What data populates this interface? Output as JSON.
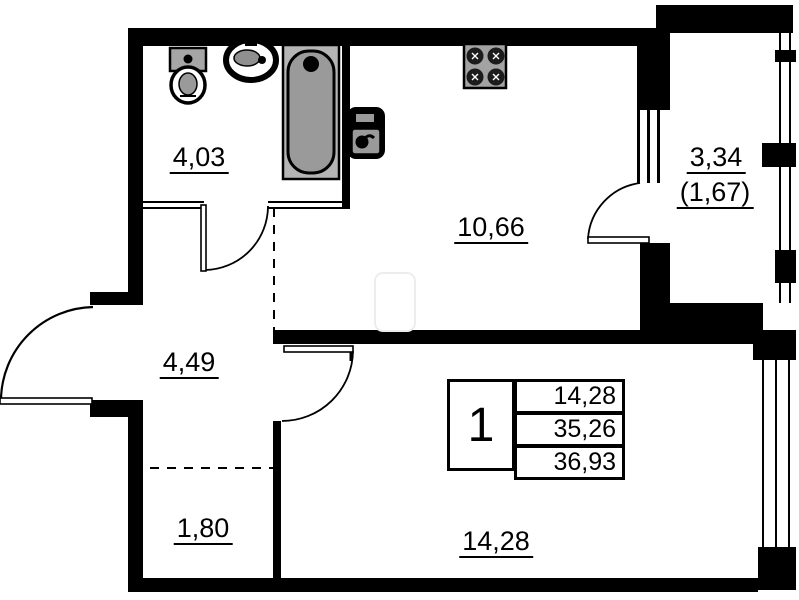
{
  "rooms": {
    "bathroom": {
      "area": "4,03"
    },
    "kitchen": {
      "area": "10,66"
    },
    "balcony": {
      "area": "3,34",
      "area_reduced": "(1,67)"
    },
    "hallway": {
      "area": "4,49"
    },
    "wardrobe": {
      "area": "1,80"
    },
    "living_room": {
      "area": "14,28"
    }
  },
  "legend": {
    "room_count": "1",
    "living_area": "14,28",
    "apartment_area": "35,26",
    "total_area": "36,93"
  },
  "colors": {
    "walls": "#000000",
    "fixture_gray": "#a6a6a6",
    "tub_gray": "#9a9a9a",
    "paper": "#ffffff"
  },
  "fixtures": [
    "toilet",
    "washbasin",
    "bathtub",
    "kitchen-sink",
    "stove"
  ]
}
